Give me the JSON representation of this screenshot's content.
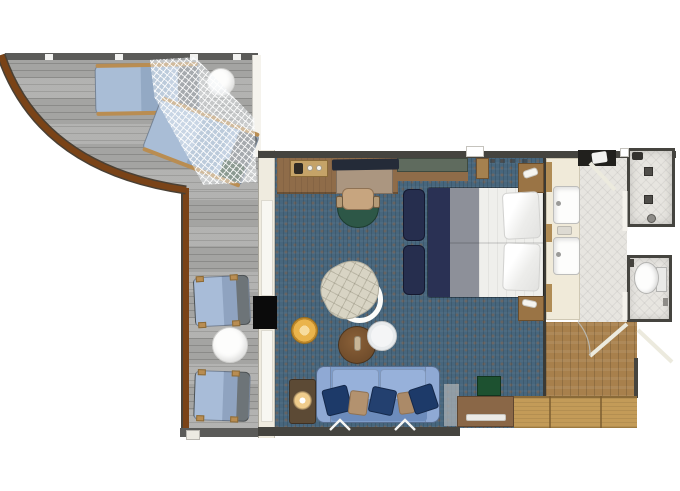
{
  "title": "cruise-suite-floor-plan",
  "palette": {
    "deck": "#a4a4a2",
    "deck_line": "#8b8b89",
    "railing": "#5b5b59",
    "rail": "#7a4317",
    "carpet": "#47667d",
    "wall_cream": "#efebdf",
    "wall_dark": "#45443f",
    "tile": "#e7e5e0",
    "wood_entry": "#a8804c",
    "wood_light": "#c39b58",
    "navy": "#262e4e",
    "bed_white": "#efefec",
    "runner": "#8d9099",
    "sofa": "#7e9dca",
    "sofa_light": "#97b1da",
    "sofa_dark": "#6d8cbc",
    "pillow_navy": "#1d3a69",
    "pillow_tan": "#b3926f",
    "cream_chair": "#d8d4c4",
    "amber": "#eab44c",
    "amber_light": "#f7dc9e",
    "amber_dark": "#c08a2c",
    "green": "#2d5747",
    "green_box": "#1d5130",
    "shelf_green": "#5f6b5e",
    "tv_black": "#0b0b0b",
    "vanity": "#f0ead9",
    "trim": "#b08c55"
  },
  "rooms": {
    "balcony": {
      "floor": "gray teak deck, curved wood rail",
      "items": [
        "sun-lounger",
        "sun-lounger",
        "hanging-mesh-net",
        "round-cocktail-table",
        "deck-chair",
        "deck-chair",
        "round-deck-table"
      ]
    },
    "living_area": {
      "floor": "blue carpet",
      "items": [
        "desk",
        "minibar-tray",
        "flat-tv-on-desk",
        "desk-extension",
        "desk-chair",
        "wall-mounted-tv",
        "swivel-armchair",
        "amber-pouf",
        "round-coffee-table",
        "round-side-table",
        "lamp-table",
        "table-lamp",
        "sofa",
        "throw-pillows"
      ]
    },
    "bedroom": {
      "floor": "blue carpet",
      "items": [
        "double-bed",
        "bed-pillows",
        "foot-bench",
        "foot-bench",
        "nightstand",
        "nightstand",
        "wall-shelf"
      ]
    },
    "bathroom": {
      "floor": "light tile",
      "items": [
        "double-vanity",
        "sink",
        "sink",
        "soap-dish",
        "towel-shelf",
        "shower-room",
        "floor-drains",
        "toilet-room",
        "toilet"
      ]
    },
    "entry": {
      "floor": "wood parquet",
      "items": [
        "entrance-double-door",
        "wardrobe",
        "dresser",
        "minibar-cabinet",
        "luggage-mat"
      ]
    }
  }
}
